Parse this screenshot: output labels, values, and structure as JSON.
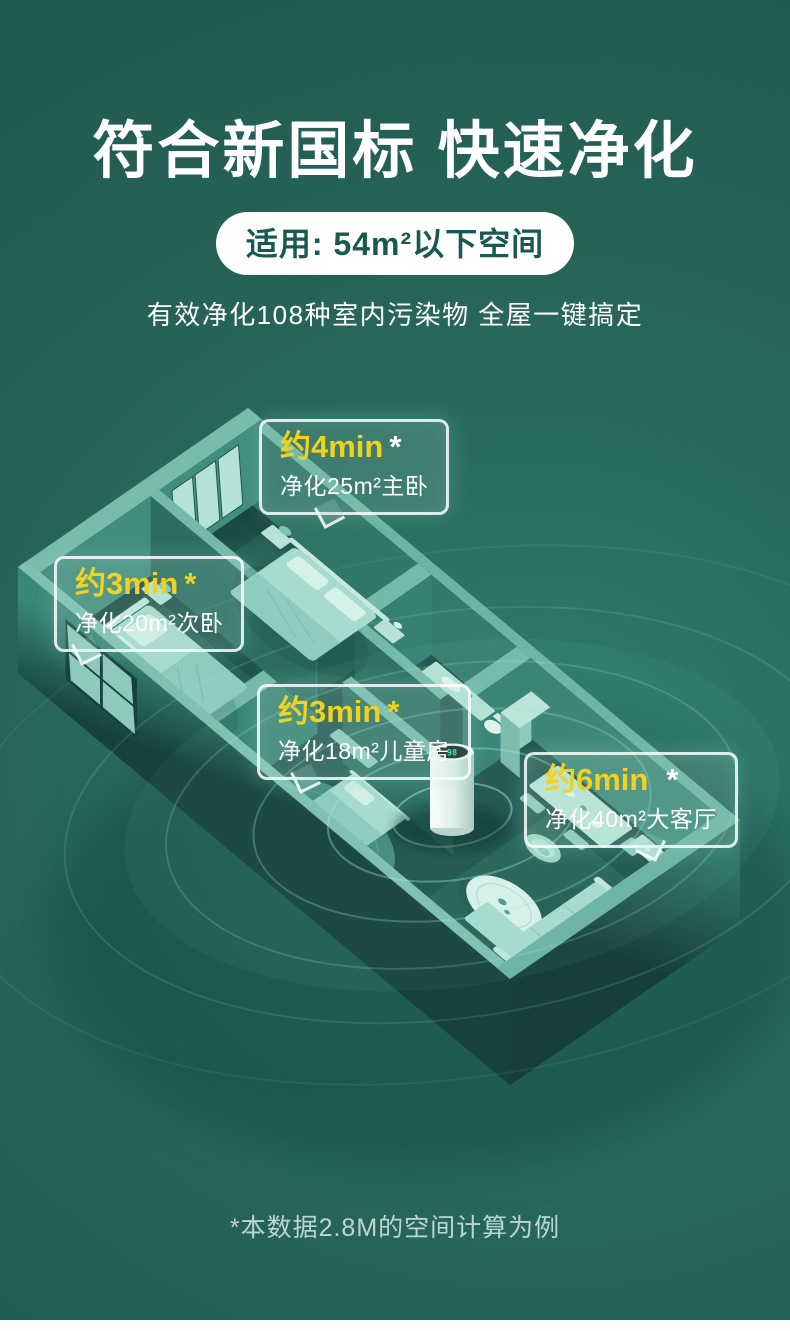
{
  "header": {
    "title": "符合新国标 快速净化",
    "badge": "适用: 54m²以下空间",
    "subtitle": "有效净化108种室内污染物 全屋一键搞定"
  },
  "callouts": [
    {
      "time": "约4min",
      "mark": "*",
      "mark_color": "#ffffff",
      "room": "净化25m²主卧"
    },
    {
      "time": "约3min",
      "mark": "*",
      "mark_color": "#f2d21c",
      "room": "净化20m²次卧"
    },
    {
      "time": "约3min",
      "mark": "*",
      "mark_color": "#f2d21c",
      "room": "净化18m²儿童房"
    },
    {
      "time": "约6min",
      "mark": "*",
      "mark_color": "#ffffff",
      "room": "净化40m²大客厅"
    }
  ],
  "floorplan": {
    "purifier_display": "98"
  },
  "footnote": "*本数据2.8M的空间计算为例",
  "colors": {
    "background": "#24635a",
    "accent_yellow": "#f2d21c",
    "badge_text": "#185a50",
    "callout_border": "rgba(250,255,253,0.85)",
    "wall_top": "#74b9a9",
    "wall_face": "#31786c",
    "floor": "#1f544d",
    "furniture": "#a8dbcf",
    "purifier_body": "#eef8f4",
    "purifier_display_text": "#39e88e"
  }
}
